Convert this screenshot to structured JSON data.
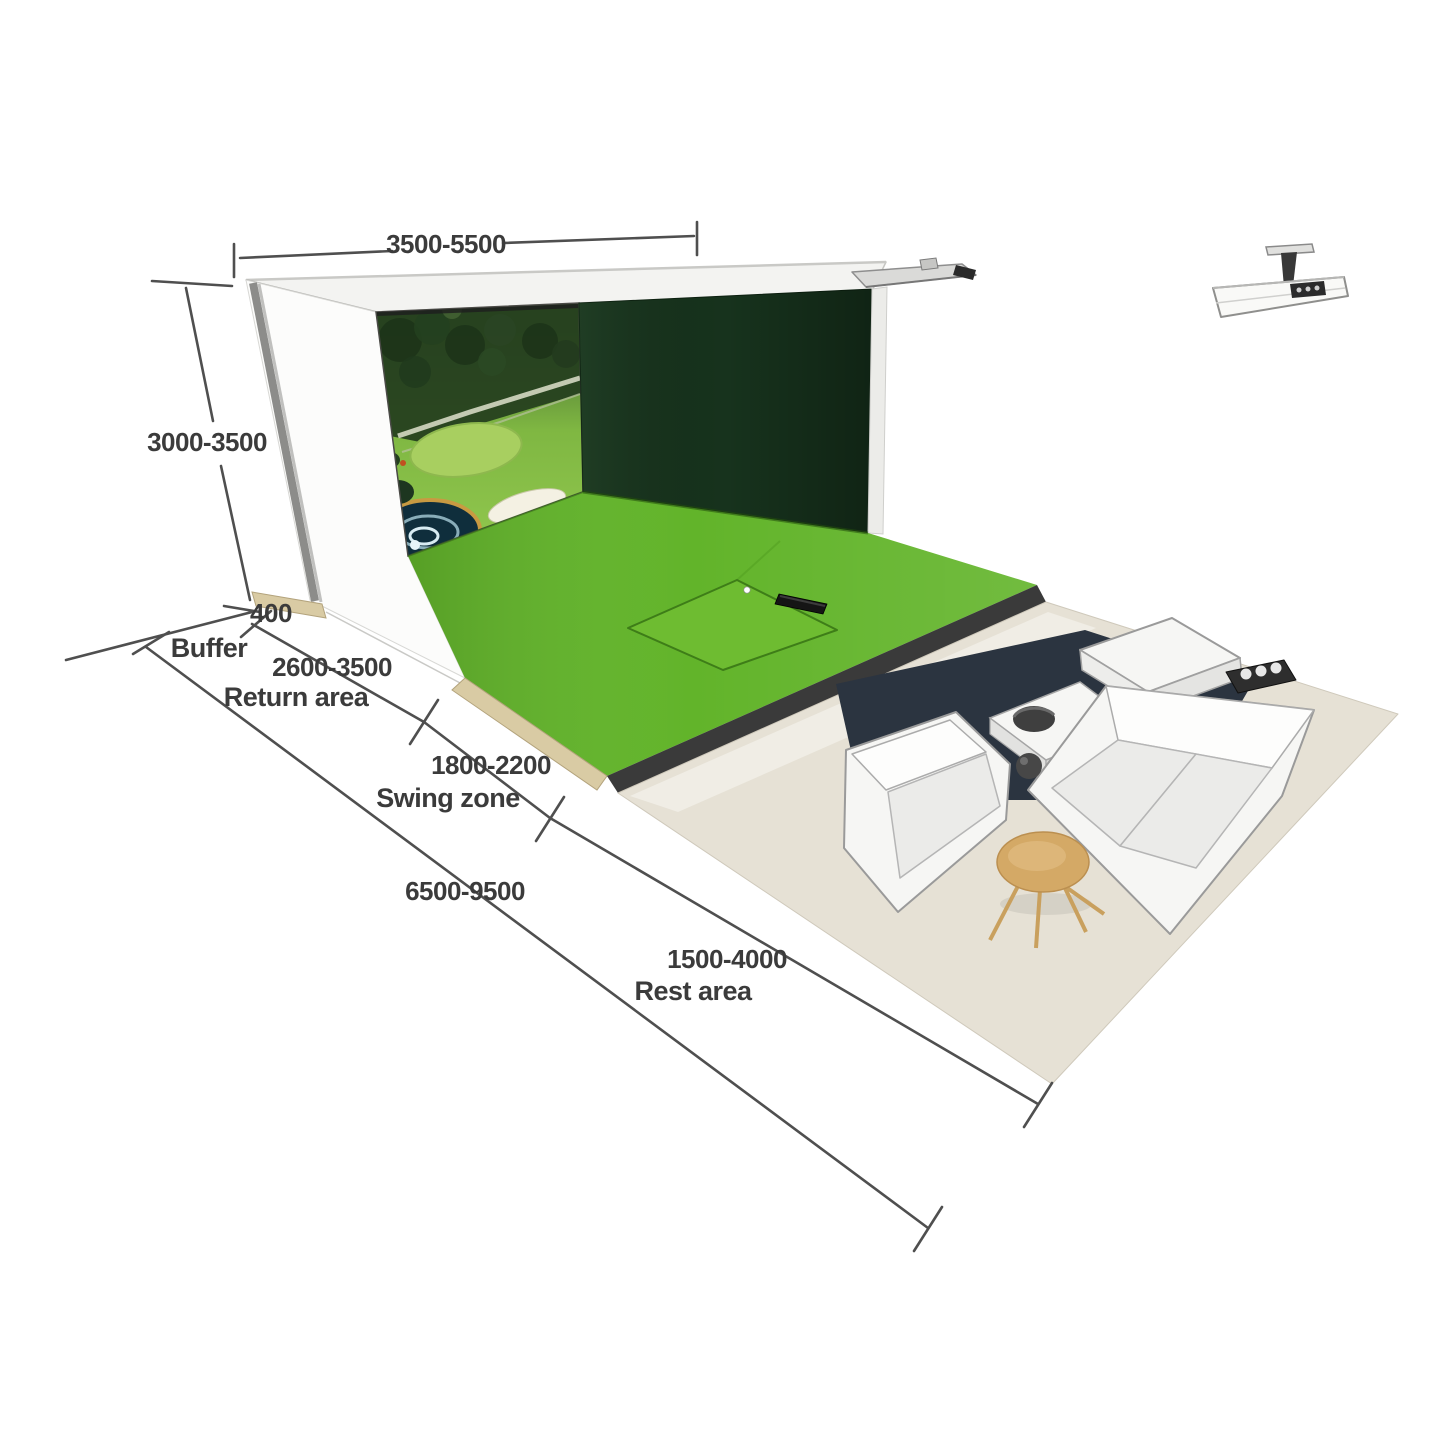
{
  "dimensions": {
    "width_value": "3500-5500",
    "height_value": "3000-3500",
    "buffer_value": "400",
    "buffer_label": "Buffer",
    "return_value": "2600-3500",
    "return_label": "Return area",
    "swing_value": "1800-2200",
    "swing_label": "Swing zone",
    "total_value": "6500-9500",
    "rest_value": "1500-4000",
    "rest_label": "Rest area"
  },
  "colors": {
    "turf_green": "#62b42a",
    "turf_inset_green": "#6ebc31",
    "impact_wall_green": "#17331d",
    "floor_beige": "#e6e1d5",
    "edge_tan": "#d9cba4",
    "pit_dark": "#2b3440",
    "table_wood": "#d4a966",
    "dimension_ink": "#3b3b3b"
  }
}
